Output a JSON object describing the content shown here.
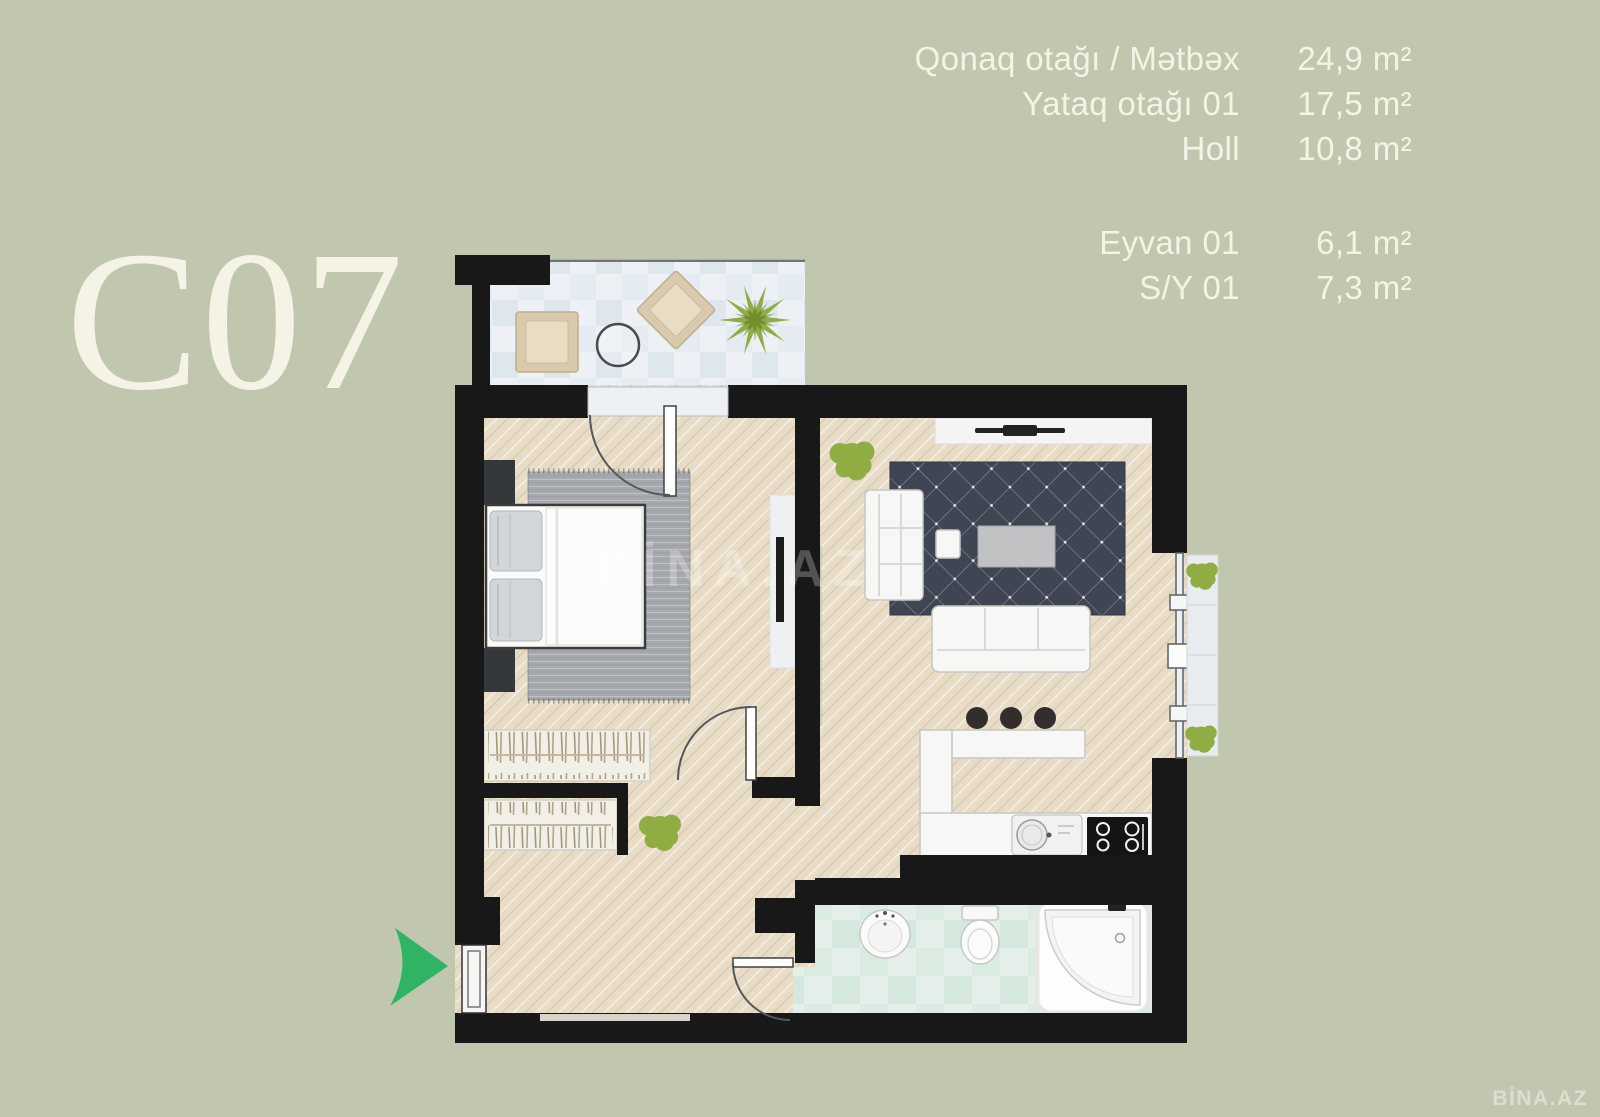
{
  "title": "C07",
  "watermark": "BİNA.AZ",
  "legend": {
    "groups": [
      {
        "rows": [
          {
            "label": "Qonaq otağı / Mətbəx",
            "value": "24,9 m²"
          },
          {
            "label": "Yataq otağı 01",
            "value": "17,5 m²"
          },
          {
            "label": "Holl",
            "value": "10,8 m²"
          }
        ]
      },
      {
        "rows": [
          {
            "label": "Eyvan 01",
            "value": "6,1 m²"
          },
          {
            "label": "S/Y 01",
            "value": "7,3 m²"
          }
        ]
      }
    ]
  },
  "colors": {
    "background": "#c1c7ae",
    "text": "#f5f3e6",
    "wall": "#181818",
    "wood": "#e8dcc6",
    "balcony-tile": "#edf1f5",
    "bath-tile": "#e0ede6",
    "rug-bedroom": "#a6a9ad",
    "rug-living": "#3f4552",
    "plant": "#8fad42",
    "arrow": "#2eb464",
    "furniture": "#f7f7f6",
    "dark-furniture": "#35383b"
  }
}
